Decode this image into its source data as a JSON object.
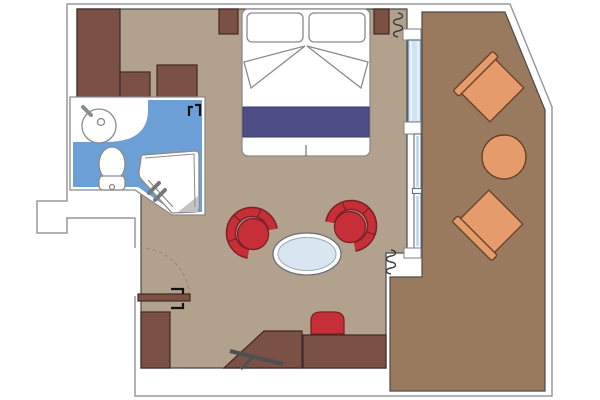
{
  "plan": {
    "type": "cruise-ship-cabin-floor-plan",
    "rooms": [
      {
        "name": "bedroom-living-room",
        "floor": "tan",
        "furniture": [
          "double-bed",
          "pillow-left",
          "pillow-right",
          "folded-sheet",
          "bed-runner",
          "nightstand-left",
          "nightstand-right",
          "wardrobe-tall",
          "wardrobe-low-left",
          "wardrobe-low-right",
          "tub-chair-left",
          "tub-chair-right",
          "oval-glass-table",
          "desk-angled",
          "desk-straight",
          "desk-chair",
          "tv-on-bracket",
          "entry-cabinet"
        ]
      },
      {
        "name": "bathroom",
        "floor": "blue",
        "fixtures": [
          "washbasin",
          "faucet",
          "toilet",
          "shower-cabin",
          "shower-handle",
          "shower-corner-mat",
          "door-handle-symbol"
        ]
      },
      {
        "name": "balcony",
        "floor": "brown",
        "furniture": [
          "deck-chair-upper",
          "round-table",
          "deck-chair-lower"
        ],
        "boundary": "angled-ship-hull"
      }
    ],
    "openings": [
      "entry-door-with-swing-arc",
      "glass-balcony-door",
      "balcony-window-upper",
      "balcony-window-lower",
      "curtain-symbol-top",
      "curtain-symbol-bottom"
    ]
  },
  "colors": {
    "floor_tan": "#b2a18c",
    "balcony_brown": "#9a7a5e",
    "furniture_brown": "#7a5144",
    "furniture_brown_dark": "#3f2a22",
    "chair_red": "#c62f38",
    "chair_red_dark": "#7d1f28",
    "bathroom_blue": "#6b9fd6",
    "glass_blue": "#cfe3f3",
    "window_blue": "#b9d5ea",
    "bed_runner": "#4e4d86",
    "table_glass": "#d9e6f2",
    "deck_orange": "#e59b6c",
    "deck_orange_dark": "#6b4226",
    "outline_gray": "#999999",
    "wall_dark": "#4a4a4a",
    "fixture_gray": "#8a8a8a",
    "tv_gray": "#4f4f4f",
    "mat_gray": "#c4c4c4",
    "swing_dash": "#9b8b74"
  }
}
